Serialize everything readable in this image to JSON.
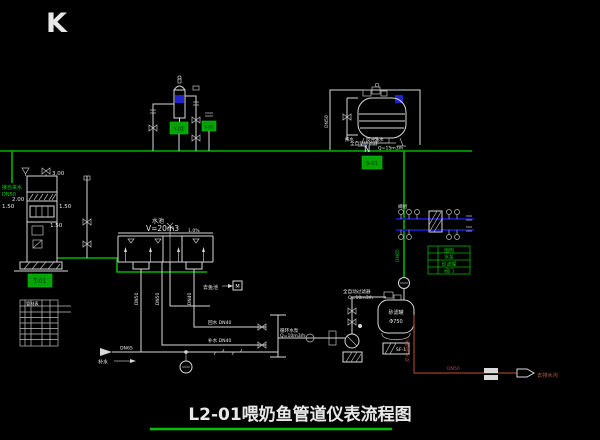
{
  "colors": {
    "background": "#000000",
    "pipe_green": "#00b400",
    "pipe_white": "#d9d9d9",
    "pipe_blue": "#1616c8",
    "return_maroon": "#7e3622",
    "marker_red": "#ff2a2a"
  },
  "marker": "K",
  "title": "L2-01喂奶鱼管道仪表流程图",
  "north_label": "N",
  "misc_labels": {
    "pipe_a": "排水",
    "pipe_b": "反冲洗水"
  },
  "left_tower": {
    "feed_label_1": "接自来水",
    "feed_label_2": "DN50",
    "dims": [
      "3.00",
      "2.00",
      "1.50",
      "1.50",
      "1.50"
    ],
    "tag": "T-01"
  },
  "top_left_unit": {
    "tag_a": "Y-01",
    "tag_b": "Y-02"
  },
  "top_right_unit": {
    "name_1": "全自动砂滤器",
    "name_2": "Q=15m3/h",
    "side_label": "DN50",
    "tag": "S-01"
  },
  "center_tank": {
    "name": "水池",
    "volume": "V=20m3",
    "slope": "1.0%",
    "drain_tags": [
      "DN50",
      "DN50",
      "DN40"
    ],
    "branch_label": "去鱼池",
    "branch_box": "M"
  },
  "branch_lines": {
    "line1": "回水 DN40",
    "line2": "补水 DN40"
  },
  "pump_line": {
    "label_1": "循环水泵",
    "label_2": "Q=10m3/h"
  },
  "filter_line": {
    "label_1": "全自动过滤器",
    "label_2": "Q=10m3/h"
  },
  "sand_filter": {
    "name_1": "砂滤罐",
    "name_2": "Φ750",
    "tag": "SF-1"
  },
  "return_line": {
    "vertical_label": "反冲洗排水",
    "size_label": "DN50",
    "end_label": "去排水沟"
  },
  "bottom_pipe": {
    "source_label": "DN65",
    "makeup_label": "补水"
  },
  "valve_station": {
    "label": "阀组",
    "riser_label": "DN65"
  },
  "legend_table": {
    "rows": [
      "图例",
      "水泵",
      "砂滤罐",
      "阀门"
    ]
  },
  "parts_table": {
    "title": "管材表"
  }
}
